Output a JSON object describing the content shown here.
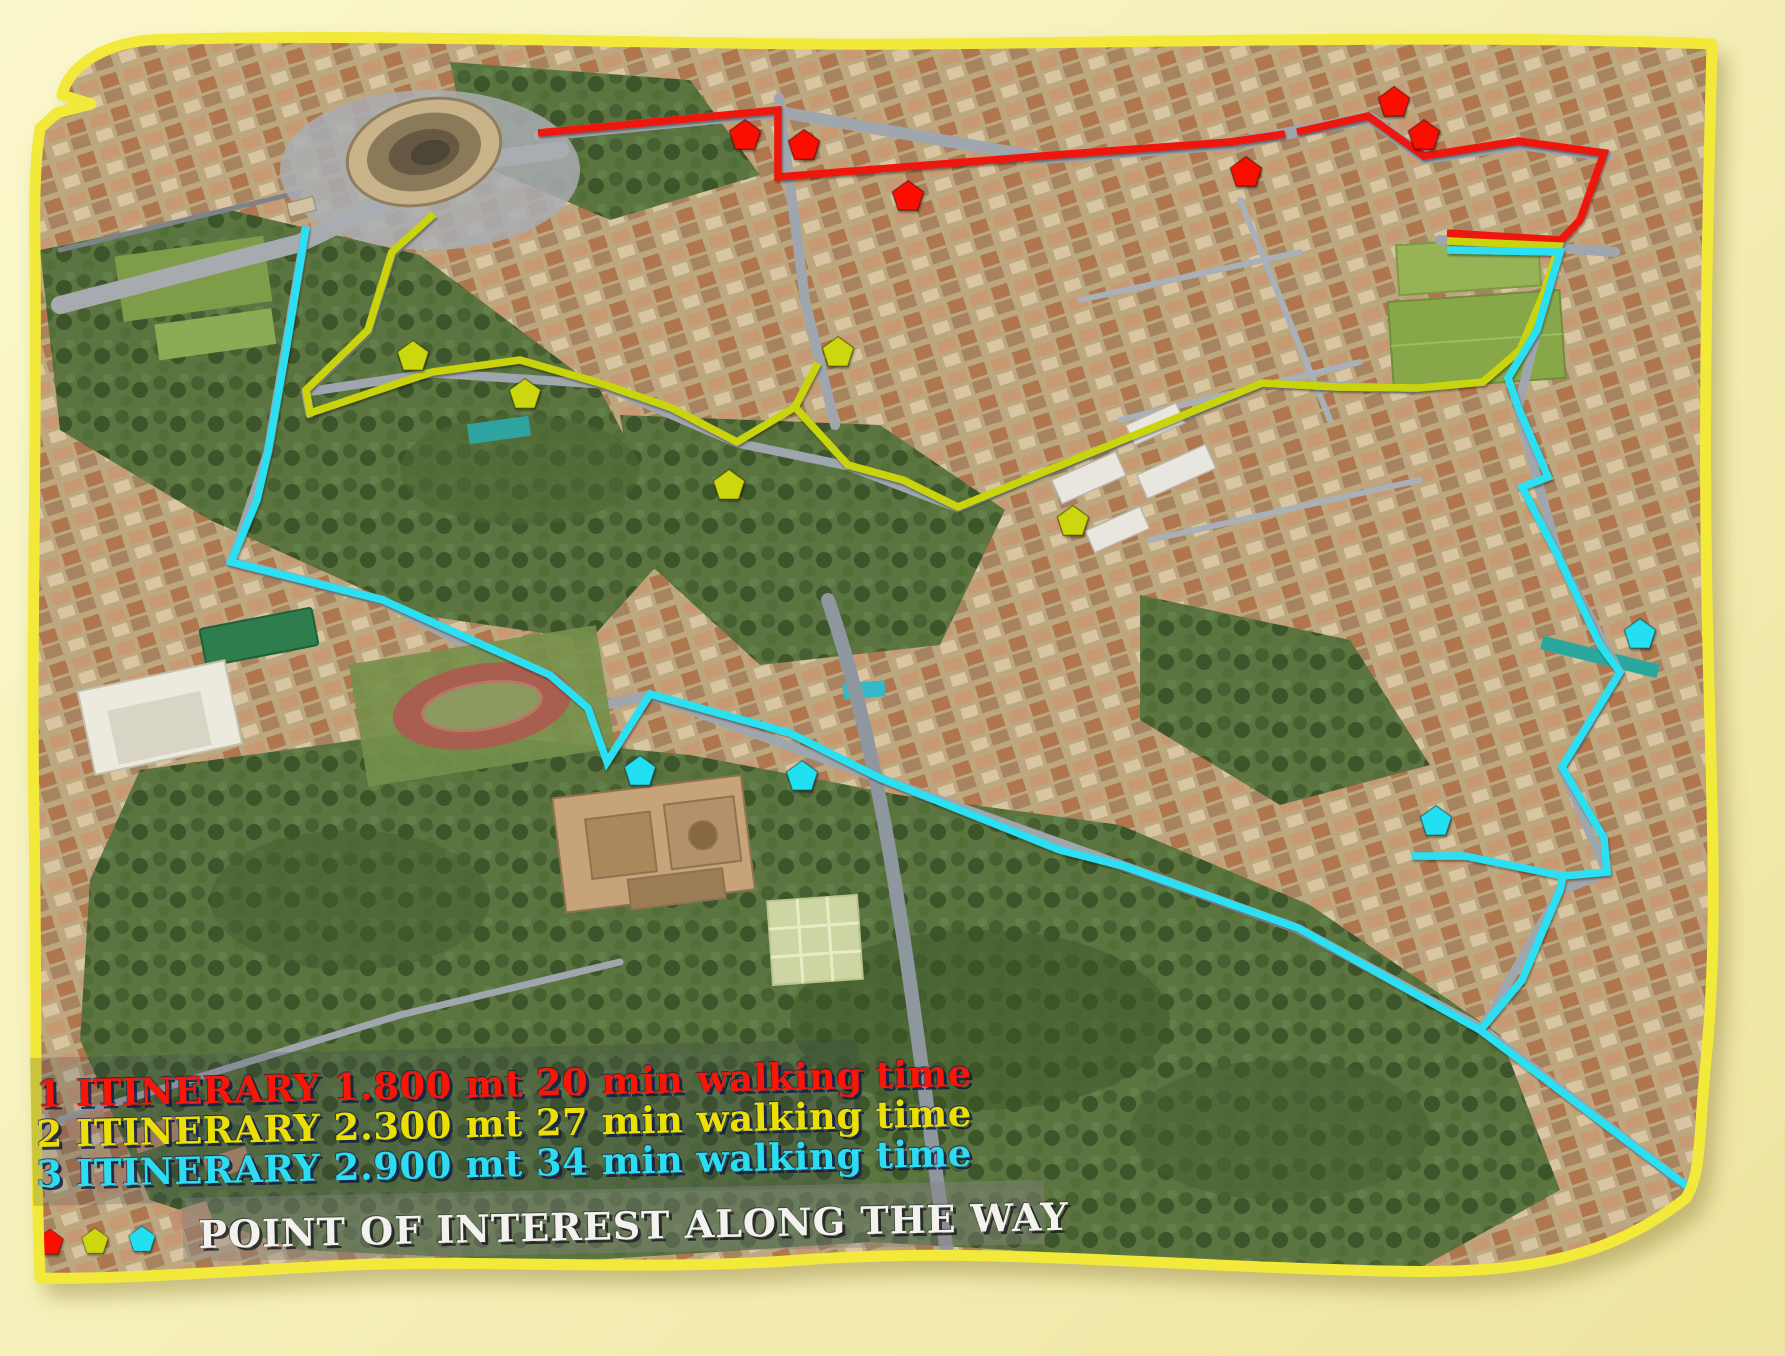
{
  "canvas": {
    "width": 1785,
    "height": 1356,
    "outer_background_top": "#faf7cb",
    "outer_background_bottom": "#eee3a0",
    "frame_border_color": "#f2e93b"
  },
  "legend": {
    "rows": [
      {
        "id": "itinerary-1",
        "text": "1 ITINERARY 1.800 mt 20 min walking time",
        "color": "#fb1507"
      },
      {
        "id": "itinerary-2",
        "text": "2 ITINERARY 2.300 mt 27 min walking time",
        "color": "#ecdf04"
      },
      {
        "id": "itinerary-3",
        "text": "3 ITINERARY 2.900 mt 34 min walking time",
        "color": "#2cdcf0"
      }
    ],
    "poi_title": "POINT OF INTEREST ALONG THE WAY",
    "poi_swatch_markers": [
      {
        "color": "#fb0b06",
        "x": 50,
        "y": 1243,
        "r": 14
      },
      {
        "color": "#ccd708",
        "x": 95,
        "y": 1242,
        "r": 14
      },
      {
        "color": "#22dff2",
        "x": 142,
        "y": 1240,
        "r": 14
      }
    ]
  },
  "routes": [
    {
      "id": "itinerary-1-route",
      "color": "#ee1407",
      "width": 7.5,
      "segments": [
        [
          [
            538,
            133
          ],
          [
            778,
            110
          ],
          [
            778,
            177
          ],
          [
            1042,
            156
          ],
          [
            1230,
            142
          ],
          [
            1285,
            134
          ]
        ],
        [
          [
            1297,
            132
          ],
          [
            1368,
            116
          ],
          [
            1424,
            156
          ],
          [
            1518,
            141
          ],
          [
            1604,
            153
          ],
          [
            1580,
            220
          ],
          [
            1561,
            240
          ],
          [
            1447,
            233
          ]
        ]
      ]
    },
    {
      "id": "itinerary-2-route",
      "color": "#c9d40a",
      "width": 7.5,
      "segments": [
        [
          [
            434,
            214
          ],
          [
            392,
            252
          ],
          [
            368,
            330
          ],
          [
            306,
            390
          ],
          [
            310,
            413
          ],
          [
            432,
            372
          ],
          [
            520,
            360
          ],
          [
            600,
            383
          ],
          [
            672,
            408
          ],
          [
            737,
            442
          ],
          [
            795,
            407
          ],
          [
            848,
            465
          ],
          [
            903,
            480
          ],
          [
            958,
            507
          ],
          [
            1262,
            383
          ],
          [
            1337,
            387
          ],
          [
            1418,
            388
          ],
          [
            1483,
            382
          ],
          [
            1520,
            350
          ],
          [
            1543,
            295
          ],
          [
            1559,
            246
          ],
          [
            1447,
            241
          ]
        ],
        [
          [
            795,
            407
          ],
          [
            818,
            363
          ]
        ]
      ]
    },
    {
      "id": "itinerary-3-route",
      "color": "#2ae0f2",
      "width": 7.5,
      "segments": [
        [
          [
            306,
            227
          ],
          [
            286,
            350
          ],
          [
            268,
            452
          ],
          [
            257,
            500
          ],
          [
            231,
            562
          ],
          [
            383,
            600
          ],
          [
            550,
            675
          ],
          [
            588,
            708
          ],
          [
            607,
            762
          ],
          [
            650,
            694
          ],
          [
            790,
            733
          ],
          [
            880,
            778
          ],
          [
            1060,
            850
          ],
          [
            1123,
            866
          ],
          [
            1298,
            928
          ],
          [
            1480,
            1030
          ],
          [
            1692,
            1190
          ]
        ],
        [
          [
            1447,
            250
          ],
          [
            1560,
            252
          ],
          [
            1537,
            330
          ],
          [
            1508,
            378
          ],
          [
            1518,
            407
          ],
          [
            1548,
            477
          ],
          [
            1522,
            487
          ],
          [
            1560,
            560
          ],
          [
            1600,
            645
          ],
          [
            1620,
            672
          ],
          [
            1562,
            767
          ],
          [
            1604,
            838
          ],
          [
            1607,
            872
          ],
          [
            1563,
            876
          ],
          [
            1560,
            890
          ],
          [
            1522,
            980
          ],
          [
            1482,
            1028
          ]
        ],
        [
          [
            1563,
            876
          ],
          [
            1465,
            856
          ],
          [
            1412,
            856
          ]
        ]
      ]
    }
  ],
  "poi_markers": {
    "marker_radius": 16.5,
    "red": {
      "color": "#fb0b06",
      "points": [
        [
          745,
          136
        ],
        [
          804,
          146
        ],
        [
          908,
          197
        ],
        [
          1246,
          173
        ],
        [
          1394,
          103
        ],
        [
          1424,
          136
        ]
      ]
    },
    "yellow": {
      "color": "#ccd708",
      "points": [
        [
          413,
          357
        ],
        [
          525,
          395
        ],
        [
          729,
          486
        ],
        [
          838,
          353
        ],
        [
          1073,
          522
        ]
      ]
    },
    "cyan": {
      "color": "#22dff2",
      "points": [
        [
          640,
          772
        ],
        [
          802,
          777
        ],
        [
          1436,
          822
        ],
        [
          1640,
          635
        ]
      ]
    }
  },
  "map_features": [
    {
      "name": "colosseum",
      "x": 424,
      "y": 152
    },
    {
      "name": "arch-of-constantine",
      "x": 300,
      "y": 207
    },
    {
      "name": "running-track",
      "x": 482,
      "y": 706
    },
    {
      "name": "green-roof-building",
      "x": 259,
      "y": 637
    },
    {
      "name": "white-office-building",
      "x": 160,
      "y": 718
    },
    {
      "name": "baths-ruins",
      "x": 665,
      "y": 855
    },
    {
      "name": "formal-garden",
      "x": 815,
      "y": 940
    },
    {
      "name": "sports-fields",
      "x": 1475,
      "y": 312
    }
  ]
}
